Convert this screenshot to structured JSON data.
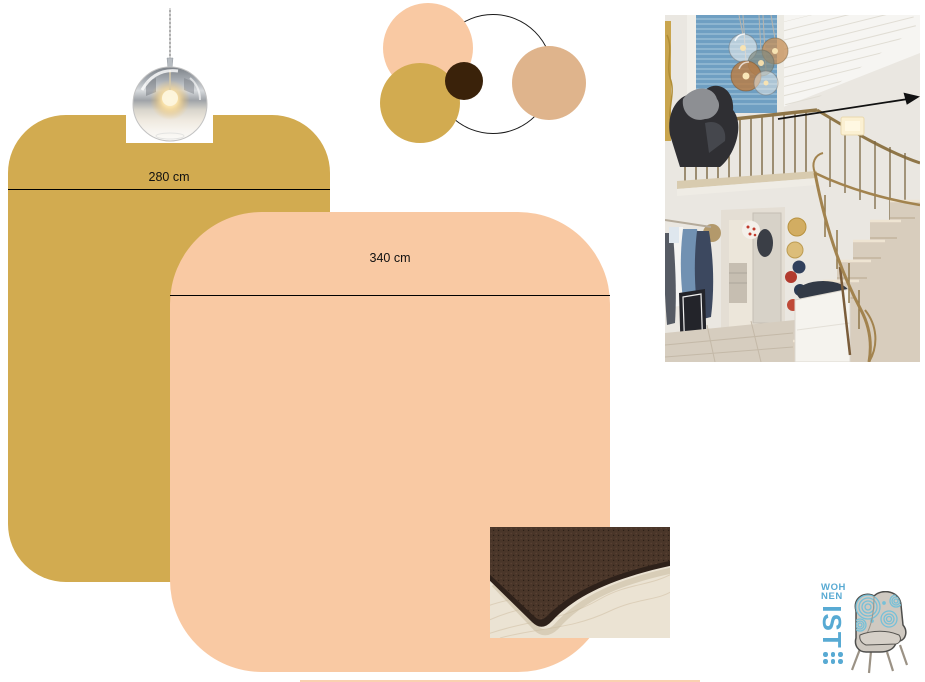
{
  "board": {
    "shapes": {
      "gold_rug": {
        "label": "280 cm",
        "color": "#d2ab50"
      },
      "peach_rug": {
        "label": "340 cm",
        "color": "#f9c9a3"
      }
    },
    "palette_circles": [
      {
        "name": "outline-ring",
        "fill": "none",
        "stroke": "#1a1a1a"
      },
      {
        "name": "peach",
        "fill": "#f9c9a3"
      },
      {
        "name": "tan",
        "fill": "#dfb48c"
      },
      {
        "name": "gold",
        "fill": "#d2ab50"
      },
      {
        "name": "dark-brown",
        "fill": "#3a220a"
      }
    ],
    "photos": {
      "pendant_lamp": {
        "name": "chrome glass globe pendant lamp"
      },
      "staircase": {
        "name": "entry hallway with brass-railed staircase, coats and hats"
      },
      "rug_sample": {
        "name": "brown rug corner on light wood floor"
      }
    },
    "arrow": {
      "color": "#111111"
    },
    "logo": {
      "word_top": "WOH",
      "word_mid": "NEN",
      "word_main": "IST",
      "color": "#58aad3"
    }
  },
  "colors": {
    "gold": "#d2ab50",
    "peach": "#f9c9a3",
    "tan": "#dfb48c",
    "brown": "#3a220a",
    "blue": "#58aad3",
    "ink": "#111111"
  }
}
